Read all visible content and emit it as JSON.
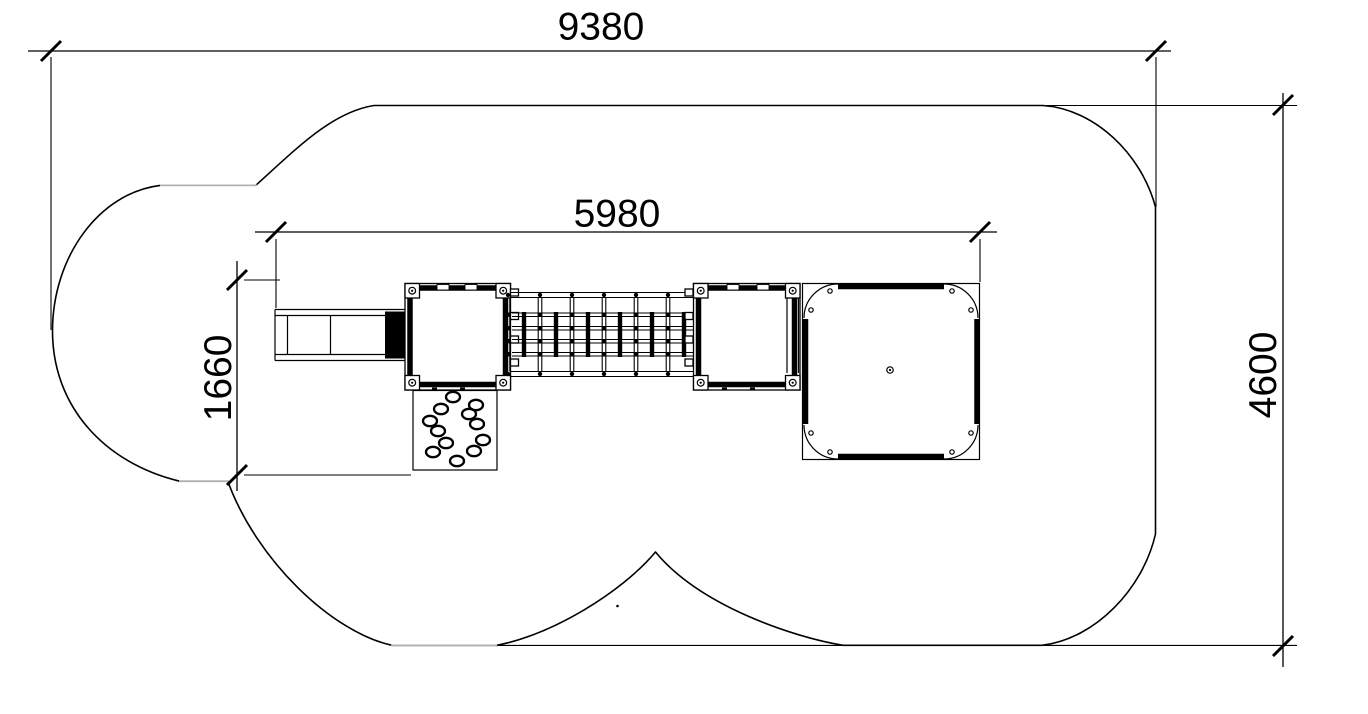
{
  "meta": {
    "drawing_type": "technical plan view (top view)",
    "subject": "playground climbing structure with free-form safety surfacing area",
    "background_color": "#ffffff",
    "line_color": "#000000",
    "construction_segment_color": "#b0b0b0"
  },
  "dimensions": {
    "overall_width": {
      "value": "9380",
      "orientation": "horizontal",
      "position": "top"
    },
    "platform_span": {
      "value": "5980",
      "orientation": "horizontal",
      "position": "middle"
    },
    "structure_depth": {
      "value": "1660",
      "orientation": "vertical",
      "position": "left"
    },
    "overall_depth": {
      "value": "4600",
      "orientation": "vertical",
      "position": "right"
    }
  },
  "components": [
    {
      "name": "safety-area-outline",
      "description": "rounded free-form impact-area boundary with left lobe and bottom cusp"
    },
    {
      "name": "access-ramp",
      "description": "segmented ramp / step unit at far left"
    },
    {
      "name": "left-tower-platform",
      "description": "square platform with four corner posts"
    },
    {
      "name": "rope-net-bridge",
      "description": "horizontal climbing net between the two platforms"
    },
    {
      "name": "right-tower-platform",
      "description": "square platform with four corner posts and side rail"
    },
    {
      "name": "large-deck",
      "description": "large square deck with rounded corner plates and center fitting"
    },
    {
      "name": "climbing-hold-wall",
      "description": "panel with twelve climbing holds in a ring"
    }
  ]
}
